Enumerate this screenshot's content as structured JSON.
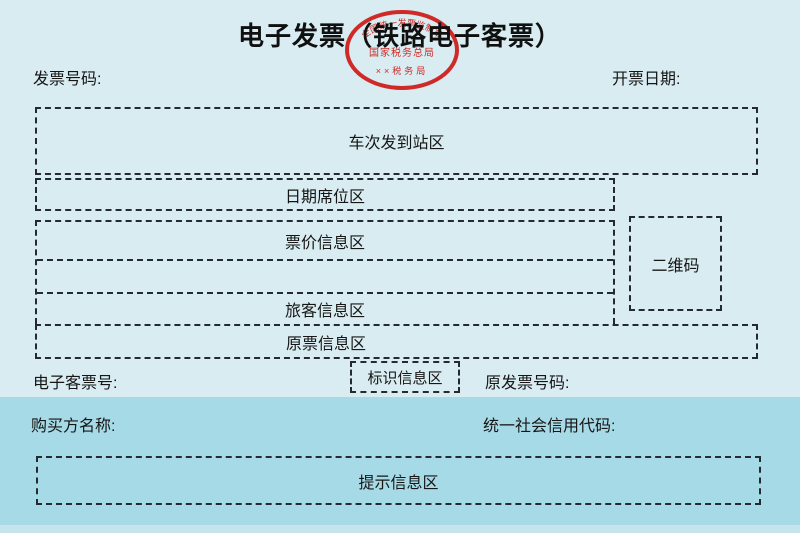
{
  "page": {
    "title": "电子发票（铁路电子客票）"
  },
  "colors": {
    "background": "#d8ecf1",
    "buyer_band": "#a6dae6",
    "bottom_strip": "#c6e4ec",
    "dashed_border": "#242a30",
    "text": "#161616",
    "seal_red": "#cf2a28"
  },
  "header": {
    "invoice_number_label": "发票号码:",
    "issue_date_label": "开票日期:"
  },
  "seal": {
    "top_arc_text": "全国统一发票监制章",
    "middle_text": "国家税务总局",
    "bottom_text": "××税务局"
  },
  "zones": {
    "train": "车次发到站区",
    "date_seat": "日期席位区",
    "fare": "票价信息区",
    "passenger": "旅客信息区",
    "original_ticket": "原票信息区",
    "qr": "二维码",
    "mark": "标识信息区",
    "tip": "提示信息区"
  },
  "fields": {
    "eticket_label": "电子客票号:",
    "original_invoice_label": "原发票号码:",
    "buyer_label": "购买方名称:",
    "credit_code_label": "统一社会信用代码:"
  }
}
